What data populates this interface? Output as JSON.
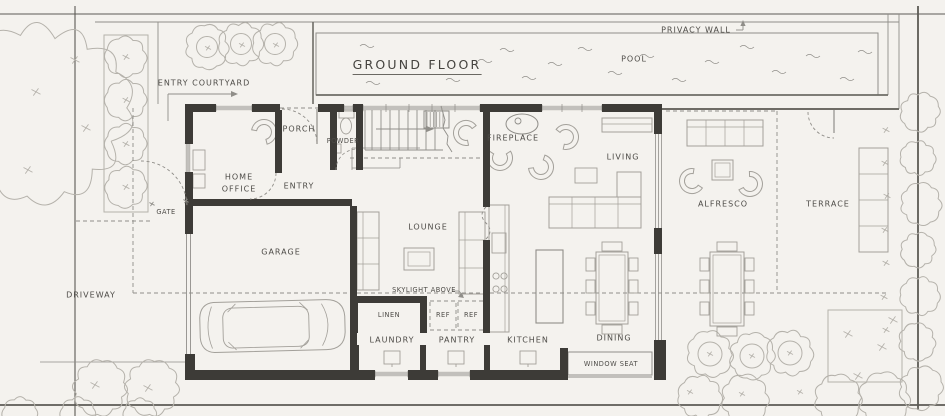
{
  "title": "GROUND FLOOR",
  "labels": {
    "privacy_wall": "PRIVACY WALL",
    "pool": "POOL",
    "entry_courtyard": "ENTRY COURTYARD",
    "porch": "PORCH",
    "powder": "POWDER",
    "home_office": "HOME OFFICE",
    "entry": "ENTRY",
    "gate": "GATE",
    "fireplace": "FIREPLACE",
    "living": "LIVING",
    "lounge": "LOUNGE",
    "garage": "GARAGE",
    "driveway": "DRIVEWAY",
    "skylight": "SKYLIGHT ABOVE",
    "linen": "LINEN",
    "ref_left": "REF",
    "ref_right": "REF",
    "laundry": "LAUNDRY",
    "pantry": "PANTRY",
    "kitchen": "KITCHEN",
    "dining": "DINING",
    "window_seat": "WINDOW SEAT",
    "alfresco": "ALFRESCO",
    "terrace": "TERRACE"
  },
  "colors": {
    "paper": "#f4f2ee",
    "line": "#908e89",
    "wall": "#3d3b37",
    "boundary": "#5c5a55",
    "text": "#4e4c48"
  }
}
